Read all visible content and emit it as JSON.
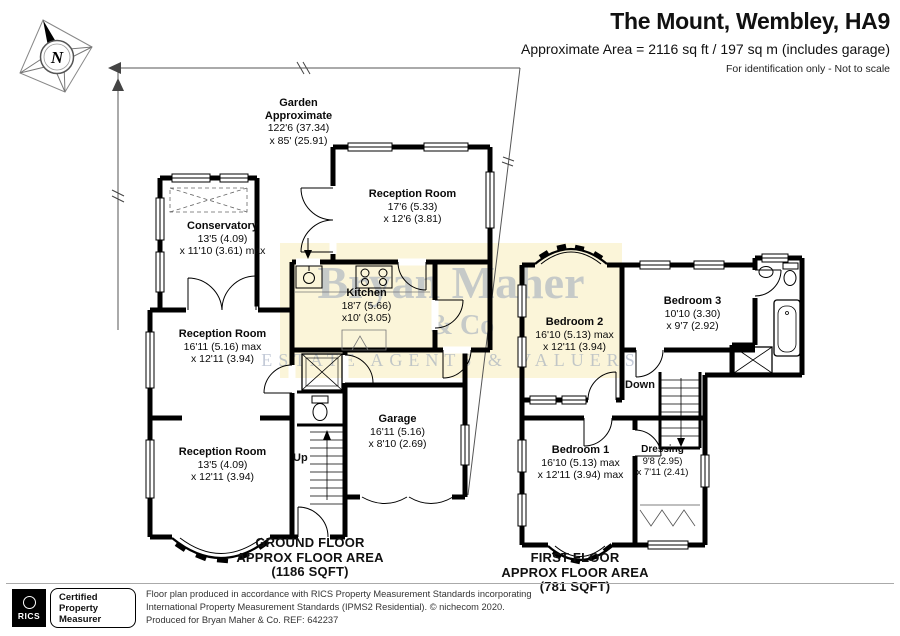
{
  "header": {
    "title": "The Mount, Wembley, HA9",
    "subtitle": "Approximate Area = 2116 sq ft / 197 sq m (includes garage)",
    "note": "For identification only - Not to scale"
  },
  "compass": {
    "label": "N"
  },
  "watermark": {
    "line1": "Bryan Maher",
    "line2": "& Co",
    "line3": "ESTATE AGENTS & VALUERS"
  },
  "garden": {
    "line1": "Garden",
    "line2": "Approximate",
    "line3": "122'6 (37.34)",
    "line4": "x 85' (25.91)"
  },
  "ground_floor": {
    "rooms": {
      "conservatory": {
        "name": "Conservatory",
        "dim1": "13'5 (4.09)",
        "dim2": "x 11'10 (3.61) max"
      },
      "reception_top": {
        "name": "Reception Room",
        "dim1": "17'6 (5.33)",
        "dim2": "x 12'6 (3.81)"
      },
      "kitchen": {
        "name": "Kitchen",
        "dim1": "18'7 (5.66)",
        "dim2": "x10' (3.05)"
      },
      "reception_mid": {
        "name": "Reception Room",
        "dim1": "16'11 (5.16) max",
        "dim2": "x 12'11 (3.94)"
      },
      "reception_bottom": {
        "name": "Reception Room",
        "dim1": "13'5 (4.09)",
        "dim2": "x 12'11 (3.94)"
      },
      "garage": {
        "name": "Garage",
        "dim1": "16'11 (5.16)",
        "dim2": "x 8'10 (2.69)"
      }
    },
    "up_label": "Up",
    "area_label": {
      "line1": "GROUND FLOOR",
      "line2": "APPROX FLOOR AREA",
      "line3": "(1186 SQFT)"
    }
  },
  "first_floor": {
    "rooms": {
      "bedroom2": {
        "name": "Bedroom 2",
        "dim1": "16'10 (5.13) max",
        "dim2": "x 12'11 (3.94)"
      },
      "bedroom3": {
        "name": "Bedroom 3",
        "dim1": "10'10 (3.30)",
        "dim2": "x 9'7 (2.92)"
      },
      "bedroom1": {
        "name": "Bedroom 1",
        "dim1": "16'10 (5.13) max",
        "dim2": "x 12'11 (3.94) max"
      },
      "dressing": {
        "name": "Dressing",
        "dim1": "9'8 (2.95)",
        "dim2": "x 7'11 (2.41)"
      }
    },
    "down_label": "Down",
    "area_label": {
      "line1": "FIRST FLOOR",
      "line2": "APPROX FLOOR AREA",
      "line3": "(781 SQFT)"
    }
  },
  "footer": {
    "rics_logo": "RICS",
    "badge": {
      "line1": "Certified",
      "line2": "Property",
      "line3": "Measurer"
    },
    "disclaimer1": "Floor plan produced in accordance with RICS Property Measurement Standards incorporating",
    "disclaimer2": "International Property Measurement Standards (IPMS2 Residential).  © nichecom 2020.",
    "disclaimer3": "Produced for Bryan Maher & Co.   REF: 642237"
  },
  "colors": {
    "wall": "#000000",
    "watermark_band": "#fbf5d9",
    "watermark_text": "#93a0b8"
  }
}
